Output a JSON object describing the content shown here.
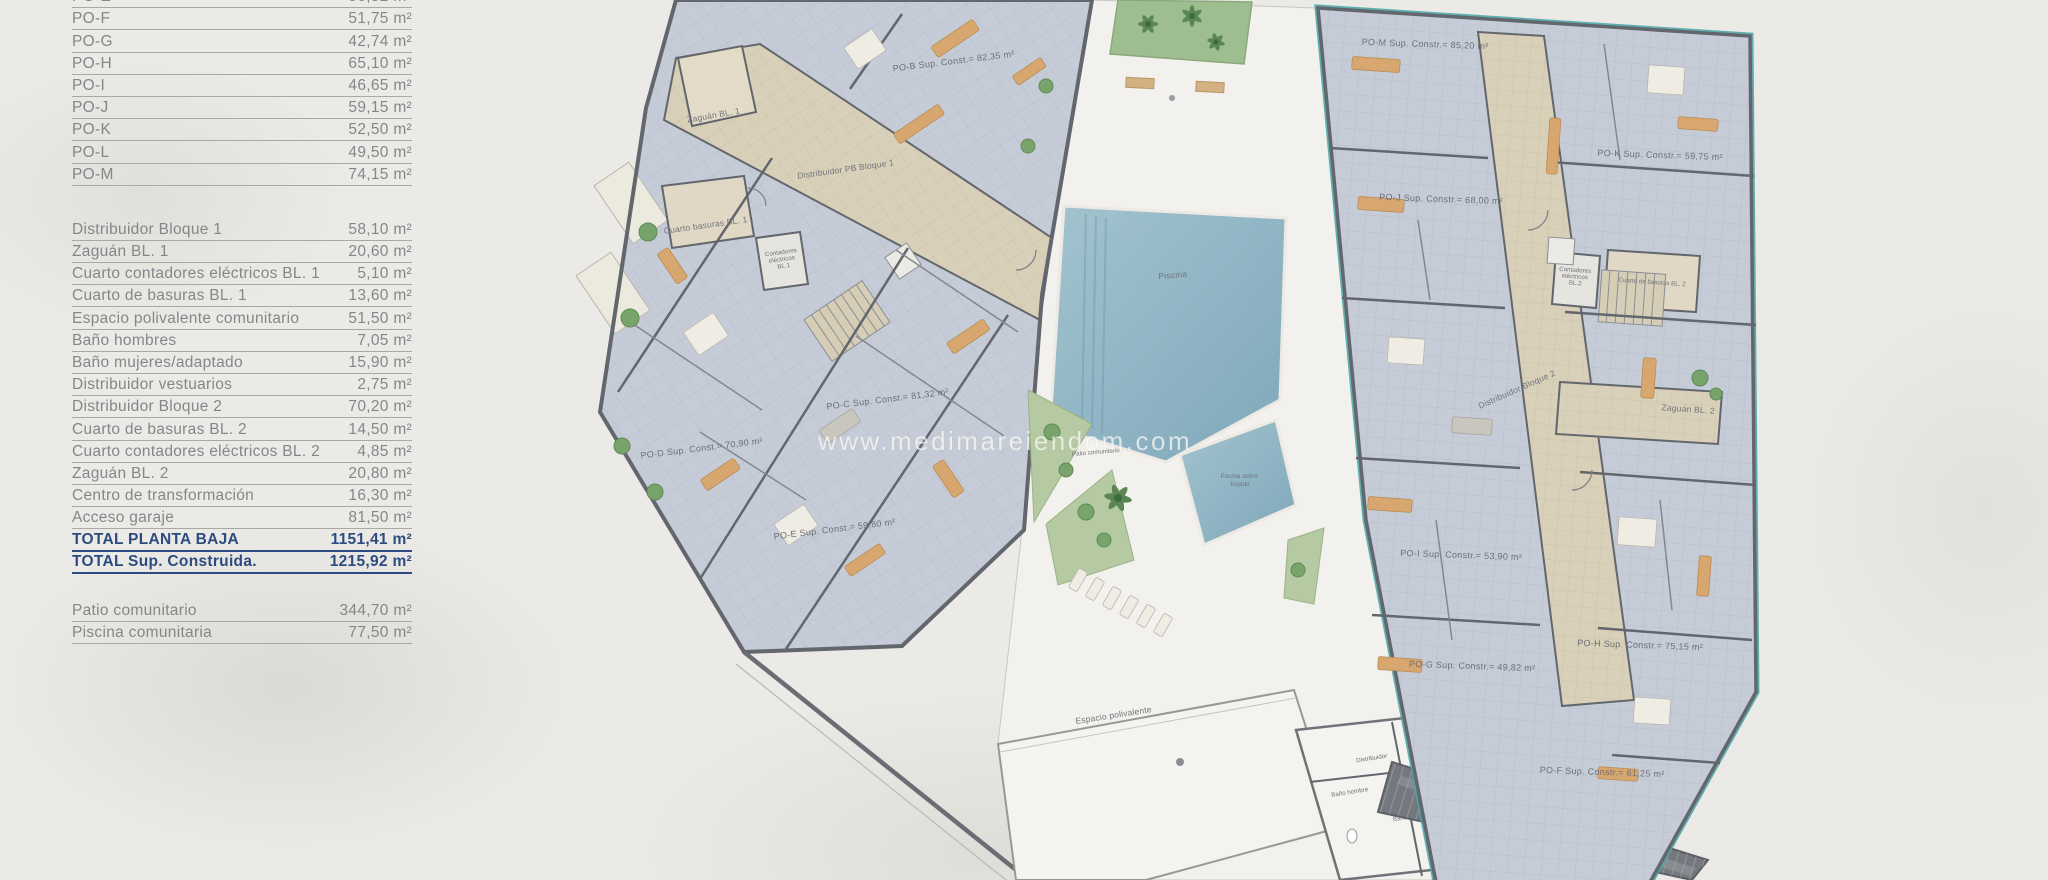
{
  "legend": {
    "apartments": [
      {
        "label": "PO-E",
        "value": "58,52 m²"
      },
      {
        "label": "PO-F",
        "value": "51,75 m²"
      },
      {
        "label": "PO-G",
        "value": "42,74 m²"
      },
      {
        "label": "PO-H",
        "value": "65,10 m²"
      },
      {
        "label": "PO-I",
        "value": "46,65 m²"
      },
      {
        "label": "PO-J",
        "value": "59,15 m²"
      },
      {
        "label": "PO-K",
        "value": "52,50 m²"
      },
      {
        "label": "PO-L",
        "value": "49,50 m²"
      },
      {
        "label": "PO-M",
        "value": "74,15 m²"
      }
    ],
    "common_areas": [
      {
        "label": "Distribuidor Bloque 1",
        "value": "58,10 m²"
      },
      {
        "label": "Zaguán BL. 1",
        "value": "20,60 m²"
      },
      {
        "label": "Cuarto contadores eléctricos BL. 1",
        "value": "5,10 m²"
      },
      {
        "label": "Cuarto de basuras BL. 1",
        "value": "13,60 m²"
      },
      {
        "label": "Espacio polivalente comunitario",
        "value": "51,50 m²"
      },
      {
        "label": "Baño hombres",
        "value": "7,05 m²"
      },
      {
        "label": "Baño mujeres/adaptado",
        "value": "15,90 m²"
      },
      {
        "label": "Distribuidor vestuarios",
        "value": "2,75 m²"
      },
      {
        "label": "Distribuidor Bloque 2",
        "value": "70,20 m²"
      },
      {
        "label": "Cuarto de basuras BL. 2",
        "value": "14,50 m²"
      },
      {
        "label": "Cuarto contadores eléctricos BL. 2",
        "value": "4,85 m²"
      },
      {
        "label": "Zaguán BL. 2",
        "value": "20,80 m²"
      },
      {
        "label": "Centro de transformación",
        "value": "16,30 m²"
      },
      {
        "label": "Acceso garaje",
        "value": "81,50 m²"
      }
    ],
    "totals": [
      {
        "label": "TOTAL PLANTA BAJA",
        "value": "1151,41 m²"
      },
      {
        "label": "TOTAL Sup. Construida.",
        "value": "1215,92 m²"
      }
    ],
    "outdoor": [
      {
        "label": "Patio comunitario",
        "value": "344,70 m²"
      },
      {
        "label": "Piscina comunitaria",
        "value": "77,50 m²"
      }
    ]
  },
  "plan": {
    "watermark": "www.medimareiendom.com",
    "block1": {
      "hall": "Distribuidor PB Bloque 1",
      "zaguan": "Zaguán BL. 1",
      "basuras": "Cuarto basuras BL. 1",
      "contadores_lines": [
        "Contadores",
        "eléctricos",
        "BL.1"
      ],
      "apartments": {
        "po_b": "PO-B Sup. Const.= 82,35 m²",
        "po_c": "PO-C Sup. Const.= 81,32 m²",
        "po_d": "PO-D Sup. Const.= 70,90 m²",
        "po_e": "PO-E Sup. Const.= 59,80 m²"
      }
    },
    "block2": {
      "hall": "Distribuidor Bloque 2",
      "zaguan": "Zaguán BL. 2",
      "basuras": "Cuarto de basuras BL. 2",
      "contadores_lines": [
        "Contadores",
        "eléctricos",
        "BL.2"
      ],
      "apartments": {
        "po_m": "PO-M Sup. Constr.= 85,20 m²",
        "po_k": "PO-K Sup. Constr.= 59,75 m²",
        "po_j": "PO-J Sup. Constr.= 68,00 m²",
        "po_i": "PO-I Sup. Constr.= 53,90 m²",
        "po_h": "PO-H Sup. Constr.= 75,15 m²",
        "po_g": "PO-G Sup. Constr.= 49,82 m²",
        "po_f": "PO-F Sup. Constr.= 61,25 m²"
      }
    },
    "site": {
      "piscina": "Piscina",
      "piscina_forjado_lines": [
        "Piscina sobre",
        "forjado"
      ],
      "patio": "Patio comunitario",
      "espacio": "Espacio polivalente",
      "distribuidor": "Distribuidor",
      "bano_hombre": "Baño hombre",
      "bano_adaptado": "Baño adaptado",
      "acceso_garaje": "Acceso garaje"
    },
    "colors": {
      "totals_blue": "#2c4c80",
      "boundary_teal": "#46a5a7",
      "pool_blue": "#8fb3c2",
      "apartment_floor": "#c6ccd7",
      "corridor_floor": "#d9d0ba"
    }
  }
}
